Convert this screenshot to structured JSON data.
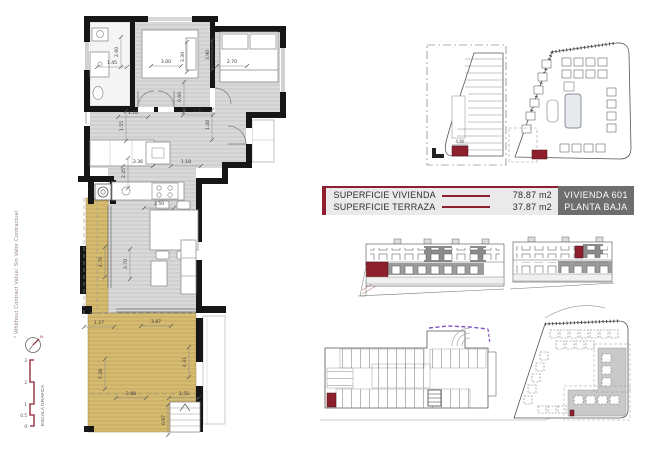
{
  "document": {
    "colors": {
      "accent": "#8e1f30",
      "dark_box": "#6d6e70",
      "terrace": "#d6bc72",
      "floor": "#d9d9d9",
      "wall": "#161616",
      "red_unit": "#8e1f2d",
      "purple": "#7d53c1"
    }
  },
  "title_block": {
    "rows": [
      {
        "label": "SUPERFICIE VIVIENDA",
        "value": "78.87 m2"
      },
      {
        "label": "SUPERFICIE TERRAZA",
        "value": "37.87 m2"
      }
    ],
    "unit_line1": "VIVIENDA 601",
    "unit_line2": "PLANTA BAJA"
  },
  "sidebar": {
    "note": "* Whithout Contract Value/ Sin Valor Contractual",
    "north_label": "N",
    "scale_label": "ESCALA GRAFICA",
    "scale_ticks": [
      "3",
      "2",
      "1",
      "0.5",
      "0"
    ]
  },
  "floor_plan": {
    "dim_labels": [
      {
        "text": "2.60",
        "x": 118,
        "y": 52,
        "rot": -90
      },
      {
        "text": "1.45",
        "x": 112,
        "y": 64,
        "rot": 0
      },
      {
        "text": "3.00",
        "x": 166,
        "y": 63,
        "rot": 0
      },
      {
        "text": "3.30",
        "x": 184,
        "y": 57,
        "rot": -90
      },
      {
        "text": "3.90",
        "x": 209,
        "y": 55,
        "rot": -90
      },
      {
        "text": "2.70",
        "x": 232,
        "y": 63,
        "rot": 0
      },
      {
        "text": "0.60",
        "x": 181,
        "y": 97,
        "rot": -90
      },
      {
        "text": "3.16",
        "x": 133,
        "y": 114,
        "rot": 0
      },
      {
        "text": "2.41",
        "x": 198,
        "y": 112,
        "rot": 0
      },
      {
        "text": "1.55",
        "x": 123,
        "y": 126,
        "rot": -90
      },
      {
        "text": "1.40",
        "x": 209,
        "y": 125,
        "rot": -90
      },
      {
        "text": "3.36",
        "x": 138,
        "y": 163,
        "rot": 0
      },
      {
        "text": "1.18",
        "x": 186,
        "y": 163,
        "rot": 0
      },
      {
        "text": "2.45",
        "x": 125,
        "y": 173,
        "rot": -90
      },
      {
        "text": "3.50",
        "x": 159,
        "y": 205,
        "rot": 0
      },
      {
        "text": "4.76",
        "x": 102,
        "y": 262,
        "rot": -90
      },
      {
        "text": "3.70",
        "x": 127,
        "y": 264,
        "rot": -90
      },
      {
        "text": "1.27",
        "x": 99,
        "y": 324,
        "rot": 0
      },
      {
        "text": "3.87",
        "x": 156,
        "y": 323,
        "rot": 0
      },
      {
        "text": "5.28",
        "x": 102,
        "y": 374,
        "rot": -90
      },
      {
        "text": "4.31",
        "x": 186,
        "y": 362,
        "rot": -90
      },
      {
        "text": "3.88",
        "x": 131,
        "y": 395,
        "rot": 0
      },
      {
        "text": "1.55",
        "x": 184,
        "y": 395,
        "rot": 0
      },
      {
        "text": "0.97",
        "x": 165,
        "y": 420,
        "rot": -90
      }
    ]
  },
  "site_plans": {
    "parking_dim": "4.80"
  }
}
